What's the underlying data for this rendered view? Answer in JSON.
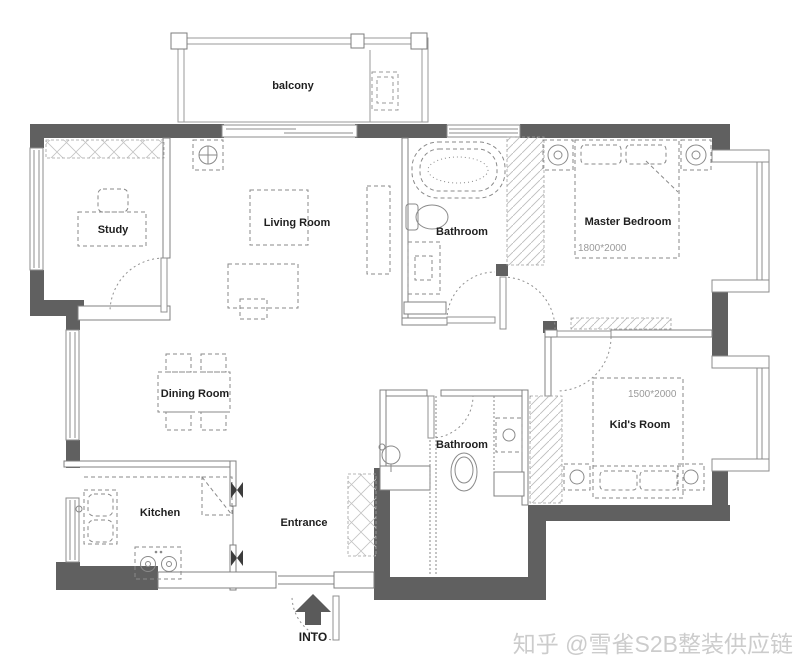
{
  "floor_plan": {
    "labels": {
      "balcony": "balcony",
      "study": "Study",
      "living_room": "Living Room",
      "bathroom_top": "Bathroom",
      "master_bedroom": "Master Bedroom",
      "master_bed_size": "1800*2000",
      "dining_room": "Dining Room",
      "bathroom_bottom": "Bathroom",
      "kids_room": "Kid's Room",
      "kids_bed_size": "1500*2000",
      "kitchen": "Kitchen",
      "entrance": "Entrance",
      "entry_direction": "INTO"
    },
    "colors": {
      "wall": "#606060",
      "thin_wall_line": "#808080",
      "furniture_line": "#8a8a8a",
      "text": "#1f1f1f",
      "dimension_text": "#9a9a9a",
      "watermark": "#cccccc"
    }
  },
  "watermark": {
    "text": "知乎 @雪雀S2B整装供应链"
  }
}
